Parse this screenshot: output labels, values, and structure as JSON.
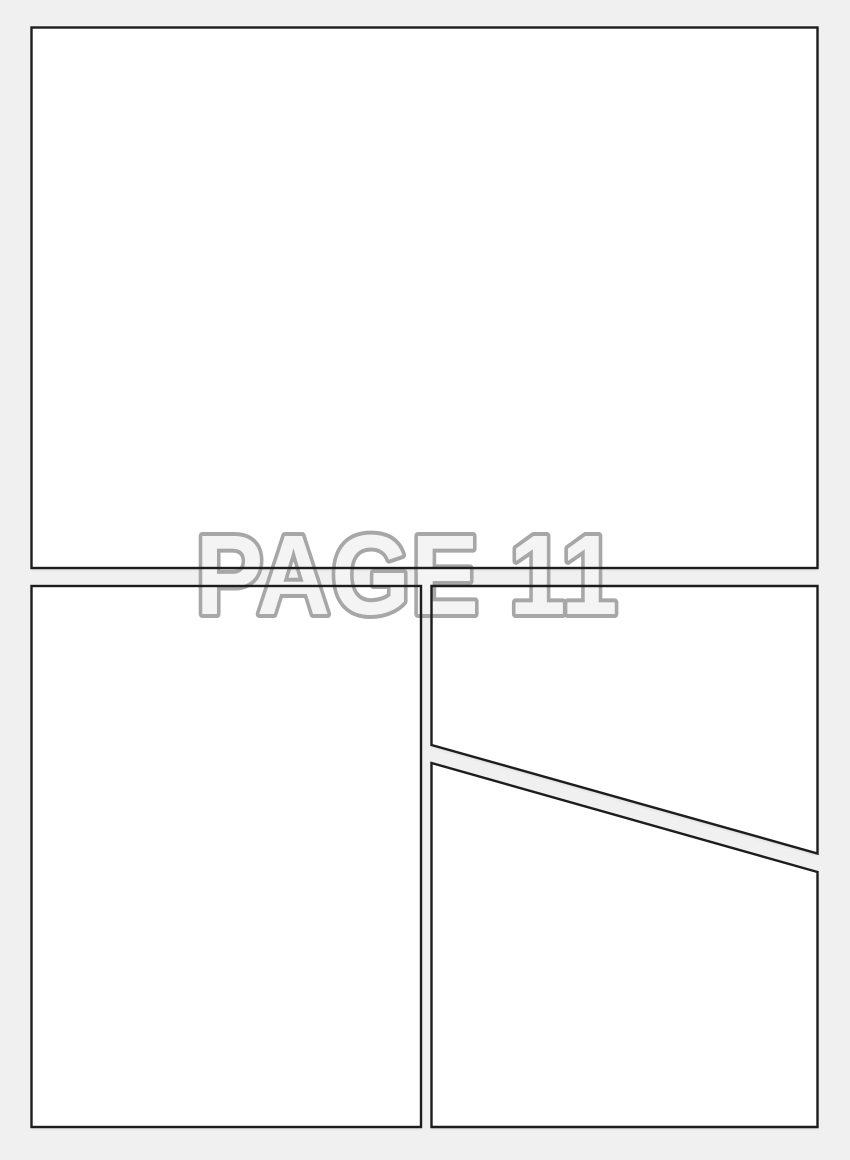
{
  "page": {
    "label": "PAGE 11"
  },
  "colors": {
    "background": "#f0f0f0",
    "panel_fill": "#ffffff",
    "panel_border": "#1d1d1d",
    "watermark_fill": "#f4f4f4",
    "watermark_outline": "#a7a7a7"
  }
}
